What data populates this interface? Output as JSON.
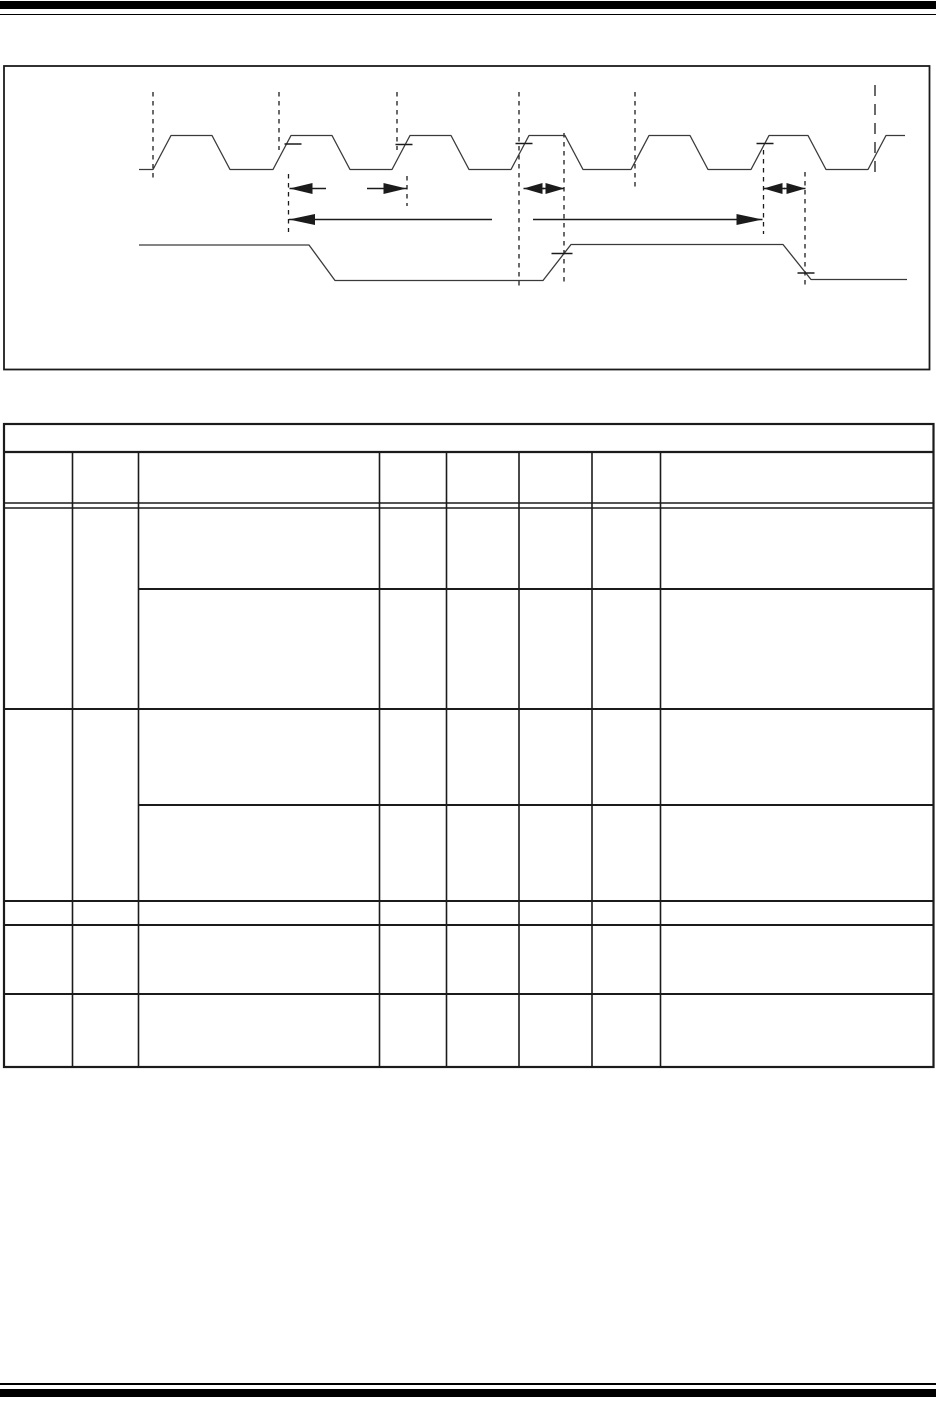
{
  "page": {
    "width": 936,
    "height": 1412,
    "background": "#ffffff",
    "rule_color": "#000000",
    "line_color": "#1b1b1b",
    "waveform_color": "#3a3a3a",
    "visible_text": []
  },
  "rules": {
    "top_bar": {
      "y": 1,
      "h": 7.5
    },
    "top_line": {
      "y": 13.5,
      "h": 1.8
    },
    "bottom_line": {
      "y": 1383,
      "h": 1.8
    },
    "bottom_bar": {
      "y": 1389,
      "h": 8
    }
  },
  "figure": {
    "box": {
      "x": 4,
      "y": 66,
      "w": 925.5,
      "h": 303.5,
      "stroke": 1.8
    },
    "clock_waveform": {
      "stroke": 1.3,
      "points": [
        [
          139,
          169.5
        ],
        [
          153,
          169.5
        ],
        [
          171,
          135.5
        ],
        [
          212,
          135.5
        ],
        [
          230,
          169.5
        ],
        [
          273,
          169.5
        ],
        [
          291,
          135.5
        ],
        [
          332,
          135.5
        ],
        [
          350,
          169.5
        ],
        [
          392,
          169.5
        ],
        [
          410,
          135.5
        ],
        [
          451,
          135.5
        ],
        [
          469,
          169.5
        ],
        [
          511,
          169.5
        ],
        [
          529,
          135.5
        ],
        [
          565,
          135.5
        ],
        [
          583,
          169.5
        ],
        [
          631,
          169.5
        ],
        [
          649,
          135.5
        ],
        [
          690,
          135.5
        ],
        [
          708,
          169.5
        ],
        [
          751,
          169.5
        ],
        [
          769,
          135.5
        ],
        [
          808,
          135.5
        ],
        [
          826,
          169.5
        ],
        [
          868,
          169.5
        ],
        [
          886,
          135.5
        ],
        [
          905,
          135.5
        ]
      ]
    },
    "data_signal_waveform": {
      "stroke": 1.3,
      "points": [
        [
          139,
          245
        ],
        [
          309,
          245
        ],
        [
          335,
          280.5
        ],
        [
          543,
          280.5
        ],
        [
          571,
          244.5
        ],
        [
          783,
          244.5
        ],
        [
          811,
          279.5
        ],
        [
          907,
          279.5
        ]
      ]
    },
    "dashed_guides": [
      {
        "x": 153,
        "y1": 92,
        "y2": 181,
        "dash": "4.5 4.5"
      },
      {
        "x": 279,
        "y1": 92,
        "y2": 150,
        "dash": "4.5 4.5"
      },
      {
        "x": 288.5,
        "y1": 174,
        "y2": 232,
        "dash": "4.5 4.5"
      },
      {
        "x": 397,
        "y1": 92,
        "y2": 150,
        "dash": "4.5 4.5"
      },
      {
        "x": 407,
        "y1": 176,
        "y2": 206,
        "dash": "4.5 4.5"
      },
      {
        "x": 519,
        "y1": 92,
        "y2": 287,
        "dash": "4.5 4.5"
      },
      {
        "x": 564,
        "y1": 133,
        "y2": 286,
        "dash": "4.5 4.5"
      },
      {
        "x": 635,
        "y1": 92,
        "y2": 191,
        "dash": "4.5 4.5"
      },
      {
        "x": 763.5,
        "y1": 150,
        "y2": 234,
        "dash": "4.5 4.5"
      },
      {
        "x": 805,
        "y1": 172,
        "y2": 288,
        "dash": "4.5 4.5"
      },
      {
        "x": 875,
        "y1": 85,
        "y2": 178,
        "dash": "11 8"
      }
    ],
    "edge_ticks": [
      {
        "cx": 293,
        "cy": 144,
        "len": 17
      },
      {
        "cx": 404,
        "cy": 144.5,
        "len": 17
      },
      {
        "cx": 524,
        "cy": 143.5,
        "len": 17
      },
      {
        "cx": 765,
        "cy": 143.5,
        "len": 17
      },
      {
        "cx": 562,
        "cy": 253.5,
        "len": 21
      },
      {
        "cx": 806,
        "cy": 273,
        "len": 17
      }
    ],
    "dimension_arrows": [
      {
        "name": "clock-period-dimension",
        "y": 188.5,
        "head_len": 23,
        "segments": [
          {
            "x1": 289.5,
            "x2": 326,
            "head": "left"
          },
          {
            "x1": 367,
            "x2": 406.5,
            "head": "right"
          }
        ]
      },
      {
        "name": "clock-high-width-dimension",
        "y": 188.5,
        "head_len": 19,
        "segments": [
          {
            "x1": 523.5,
            "x2": 544,
            "head": "left"
          },
          {
            "x1": 543,
            "x2": 564.5,
            "head": "right"
          }
        ]
      },
      {
        "name": "clock-to-data-dimension",
        "y": 188.5,
        "head_len": 19,
        "segments": [
          {
            "x1": 763.5,
            "x2": 785,
            "head": "left"
          },
          {
            "x1": 784,
            "x2": 805.5,
            "head": "right"
          }
        ]
      },
      {
        "name": "data-valid-span-dimension",
        "y": 219.5,
        "head_len": 26,
        "segments": [
          {
            "x1": 289,
            "x2": 492,
            "head": "left"
          },
          {
            "x1": 533,
            "x2": 762.5,
            "head": "right"
          }
        ]
      }
    ]
  },
  "table": {
    "x1": 4,
    "x2": 933.5,
    "y1": 424,
    "y2": 1067,
    "outer_stroke": 2.2,
    "inner_stroke": 1.6,
    "caption_row_bottom": 452,
    "column_lines_x": [
      72.5,
      138.5,
      379.5,
      446.5,
      519,
      592,
      660.5
    ],
    "column_lines_top": 452,
    "header_double_line_ys": [
      503,
      508
    ],
    "full_row_lines_y": [
      709,
      901,
      925,
      994
    ],
    "partial_row_lines": [
      {
        "y": 589,
        "x1": 138.5
      },
      {
        "y": 805,
        "x1": 138.5
      }
    ],
    "columns_count": 8,
    "body_row_bands_y": [
      [
        509,
        589
      ],
      [
        589,
        709
      ],
      [
        709,
        805
      ],
      [
        805,
        901
      ],
      [
        901,
        925
      ],
      [
        925,
        994
      ],
      [
        994,
        1067
      ]
    ]
  }
}
